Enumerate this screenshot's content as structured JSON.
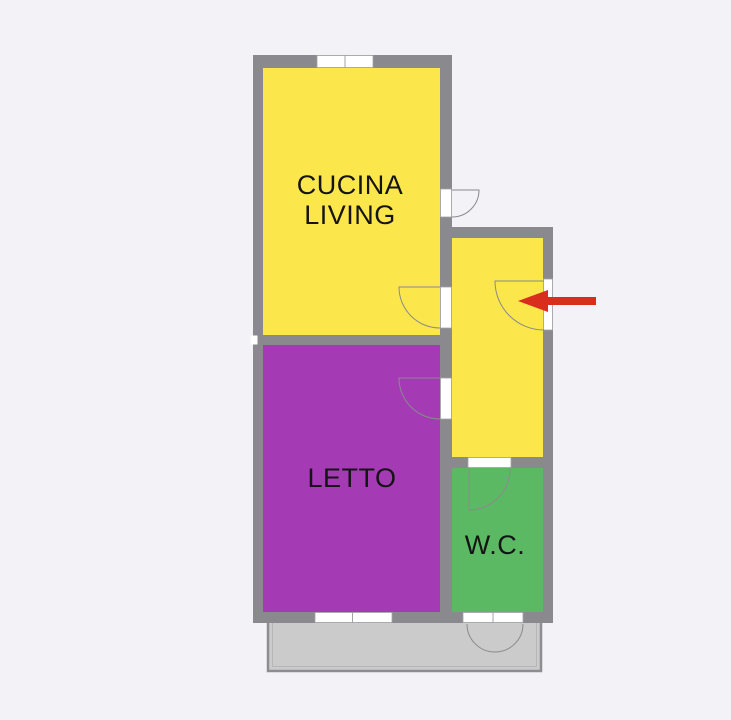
{
  "colors": {
    "background": "#F2F2F7",
    "wall": "#8A8A8E",
    "room_kitchen": "#FBE64B",
    "room_hallway": "#FBE64B",
    "room_bedroom": "#A53AB5",
    "room_wc": "#5BB963",
    "balcony_fill": "#CBCBCB",
    "balcony_border": "#8E8E92",
    "balcony_inner_line": "#B6B6BA",
    "opening": "#FFFFFF",
    "opening_outline": "#A3A3A7",
    "door_swing": "#8A8A8E",
    "entrance_arrow": "#D92D1E",
    "label_text": "#141414"
  },
  "labels": {
    "kitchen_line1": "CUCINA",
    "kitchen_line2": "LIVING",
    "bedroom": "LETTO",
    "wc": "W.C."
  }
}
